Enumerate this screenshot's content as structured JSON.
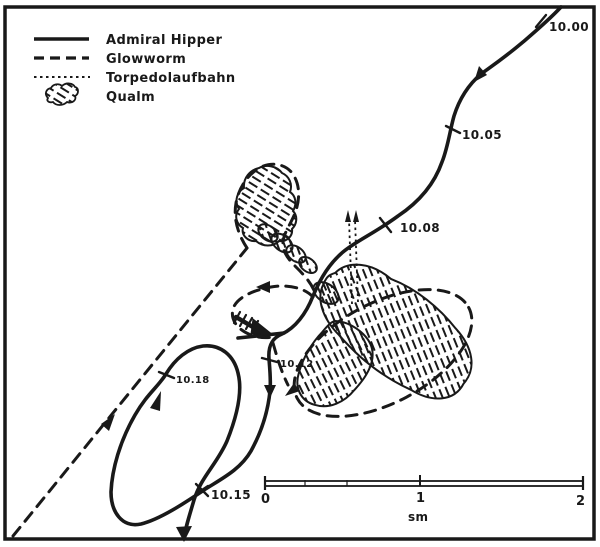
{
  "diagram": {
    "type": "naval-track-chart",
    "language": "German"
  },
  "legend": {
    "items": [
      {
        "id": "admiral-hipper",
        "label": "Admiral Hipper",
        "line_style": "solid"
      },
      {
        "id": "glowworm",
        "label": "Glowworm",
        "line_style": "dashed"
      },
      {
        "id": "torpedolaufbahn",
        "label": "Torpedolaufbahn",
        "line_style": "dotted"
      },
      {
        "id": "qualm",
        "label": "Qualm",
        "line_style": "smoke-cloud"
      }
    ]
  },
  "time_labels": [
    {
      "time": "10.00",
      "track": "admiral-hipper"
    },
    {
      "time": "10.05",
      "track": "admiral-hipper"
    },
    {
      "time": "10.08",
      "track": "admiral-hipper"
    },
    {
      "time": "10.12",
      "track": "admiral-hipper"
    },
    {
      "time": "10.15",
      "track": "admiral-hipper"
    },
    {
      "time": "10.18",
      "track": "admiral-hipper"
    }
  ],
  "scale_bar": {
    "ticks": [
      "0",
      "1",
      "2"
    ],
    "unit": "sm"
  },
  "colors": {
    "ink": "#191919",
    "paper": "#ffffff"
  }
}
